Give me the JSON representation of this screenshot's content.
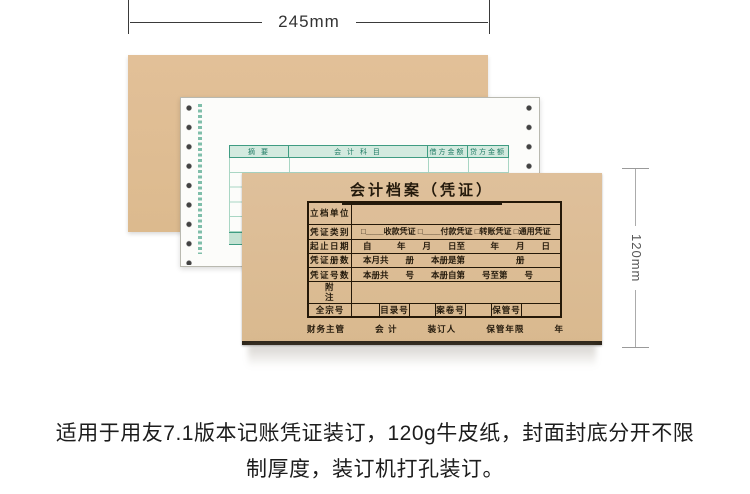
{
  "dim_top": {
    "label": "245mm"
  },
  "dim_right": {
    "label": "120mm"
  },
  "voucher_sheet": {
    "headers": [
      "摘  要",
      "会 计 科 目",
      "借方金额",
      "贷方金额"
    ]
  },
  "cover": {
    "title": "会计档案（凭证）",
    "rows": [
      {
        "label": "立档单位",
        "content": ""
      },
      {
        "label": "凭证类别",
        "content": "□____收款凭证 □____付款凭证 □转账凭证 □通用凭证"
      },
      {
        "label": "起止日期",
        "content": "自　　　年　　月　　日至　　　年　　月　　日"
      },
      {
        "label": "凭证册数",
        "content": "本月共　　册　　本册是第　　　　　　册"
      },
      {
        "label": "凭证号数",
        "content": "本册共　　号　　本册自第　　号至第　　号"
      },
      {
        "label": "附注",
        "content": ""
      }
    ],
    "archive_row": [
      "全宗号",
      "",
      "目录号",
      "",
      "案卷号",
      "",
      "保管号",
      ""
    ],
    "footer": [
      "财务主管",
      "会  计",
      "装订人",
      "保管年限",
      "年"
    ]
  },
  "caption": {
    "line1": "适用于用友7.1版本记账凭证装订，120g牛皮纸，封面封底分开不限",
    "line2": "制厚度，装订机打孔装订。"
  }
}
